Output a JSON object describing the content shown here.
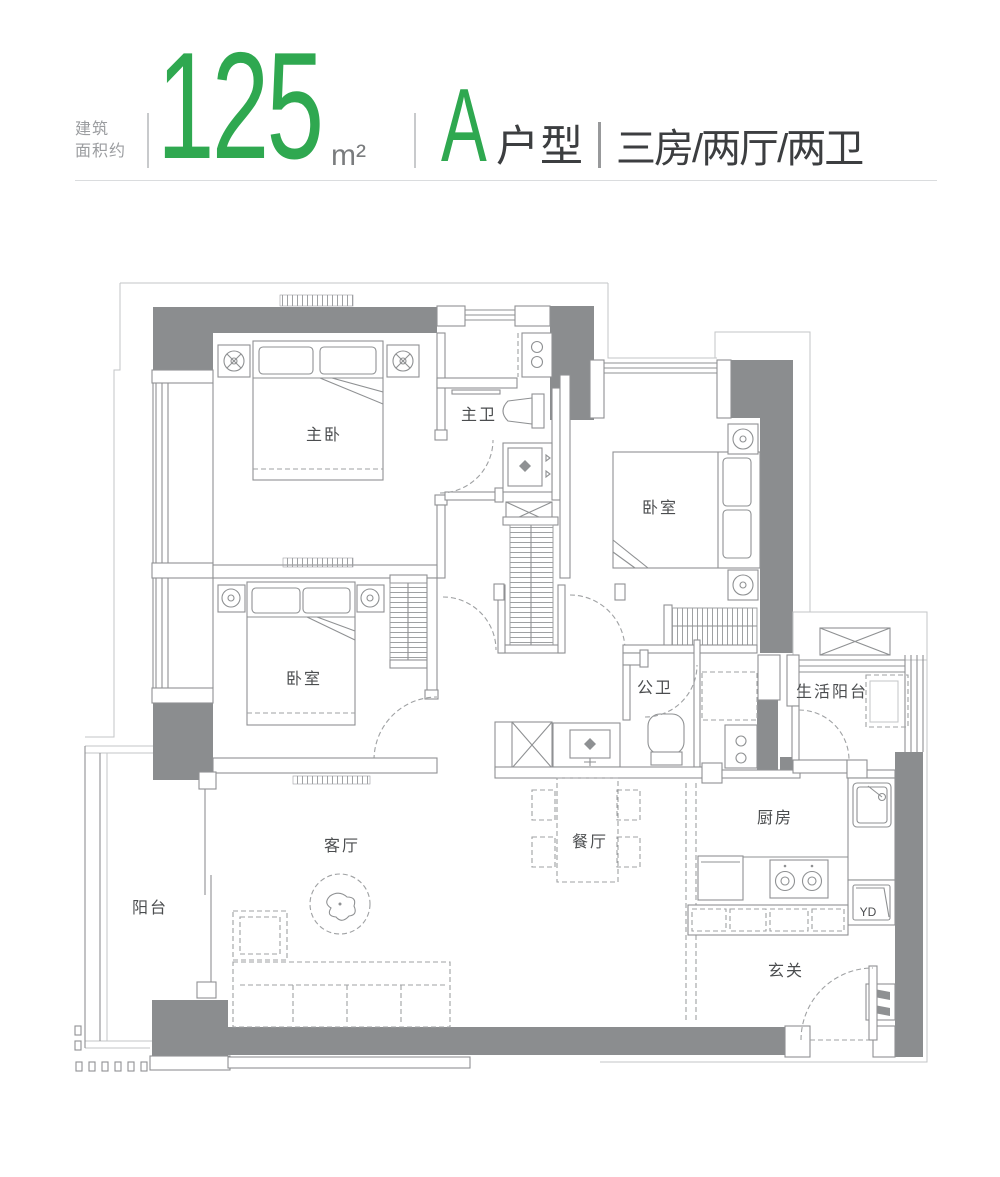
{
  "header": {
    "area_prefix_line1": "建筑",
    "area_prefix_line2": "面积约",
    "area_value": "125",
    "area_unit": "m²",
    "unit_name": "A",
    "unit_type_suffix": "户型",
    "layout_desc": "三房/两厅/两卫",
    "accent_green": "#2fa850",
    "text_dark": "#3c3e40",
    "text_gray": "#9b9da0"
  },
  "floorplan": {
    "wall_color": "#8b8d8f",
    "line_color": "#8f9193",
    "rooms": [
      {
        "id": "master-bedroom",
        "label": "主卧"
      },
      {
        "id": "master-bathroom",
        "label": "主卫"
      },
      {
        "id": "bedroom-east",
        "label": "卧室"
      },
      {
        "id": "bedroom-west",
        "label": "卧室"
      },
      {
        "id": "public-bathroom",
        "label": "公卫"
      },
      {
        "id": "service-balcony",
        "label": "生活阳台"
      },
      {
        "id": "kitchen",
        "label": "厨房"
      },
      {
        "id": "dining-room",
        "label": "餐厅"
      },
      {
        "id": "living-room",
        "label": "客厅"
      },
      {
        "id": "balcony",
        "label": "阳台"
      },
      {
        "id": "foyer",
        "label": "玄关"
      }
    ],
    "fixtures": {
      "flue_label": "YD"
    }
  }
}
